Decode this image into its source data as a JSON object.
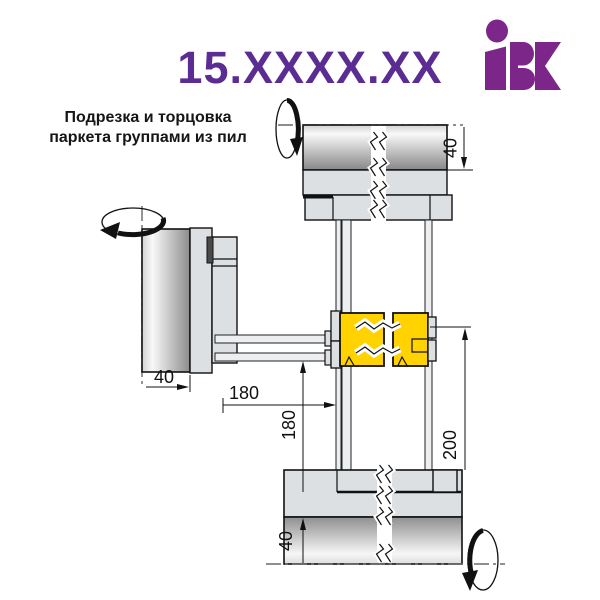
{
  "header": {
    "code": "15.XXXX.XX",
    "logo_text": "IBK"
  },
  "caption": {
    "line1": "Подрезка и торцовка",
    "line2": "паркета группами из пил"
  },
  "dimensions": {
    "top_roller_offset": "40",
    "left_cylinder_width": "40",
    "horizontal_offset": "180",
    "vertical_offset": "180",
    "saw_group_span": "200",
    "bottom_roller_offset": "40"
  },
  "colors": {
    "title_purple": "#5b2c92",
    "logo_purple": "#7d2689",
    "saw_group_yellow": "#ffd200",
    "machine_body_gray": "#dde0e3",
    "outline_black": "#111111"
  }
}
